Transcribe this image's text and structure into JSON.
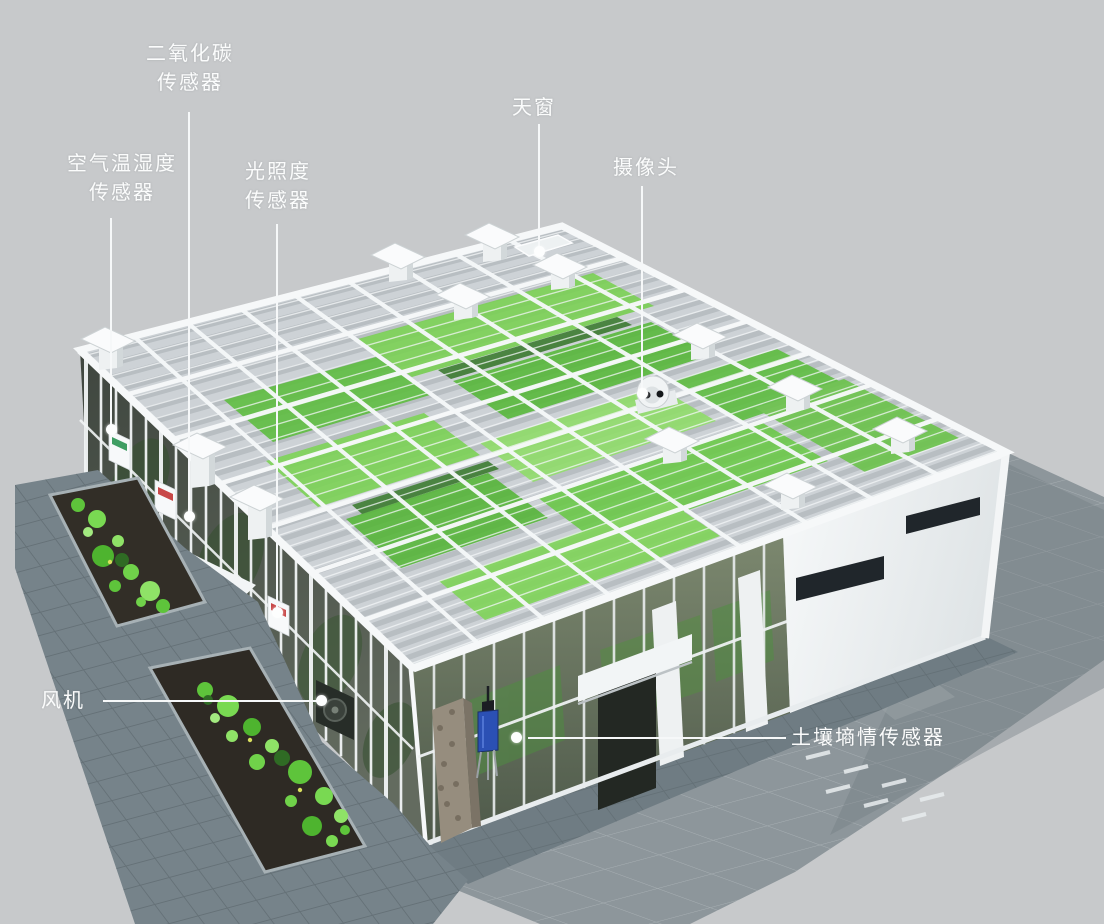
{
  "callouts": [
    {
      "id": "co2-sensor",
      "label": "二氧化碳\n传感器"
    },
    {
      "id": "air-temp-humidity-sensor",
      "label": "空气温湿度\n传感器"
    },
    {
      "id": "light-intensity-sensor",
      "label": "光照度\n传感器"
    },
    {
      "id": "skylight",
      "label": "天窗"
    },
    {
      "id": "camera",
      "label": "摄像头"
    },
    {
      "id": "fan",
      "label": "风机"
    },
    {
      "id": "soil-moisture-sensor",
      "label": "土壤墒情传感器"
    }
  ],
  "colors": {
    "background": "#c7c9cb",
    "label_text": "#fbfcfc",
    "leader_line": "#f6f8f9",
    "frame_white": "#f2f5f6",
    "crop_green": "#5fb542",
    "paving_slate": "#76838a",
    "paving_shadow": "#8d969b",
    "planter_soil": "#322e27",
    "lilypad_green": "#67cc42",
    "soil_sensor_blue": "#2b50b4"
  }
}
